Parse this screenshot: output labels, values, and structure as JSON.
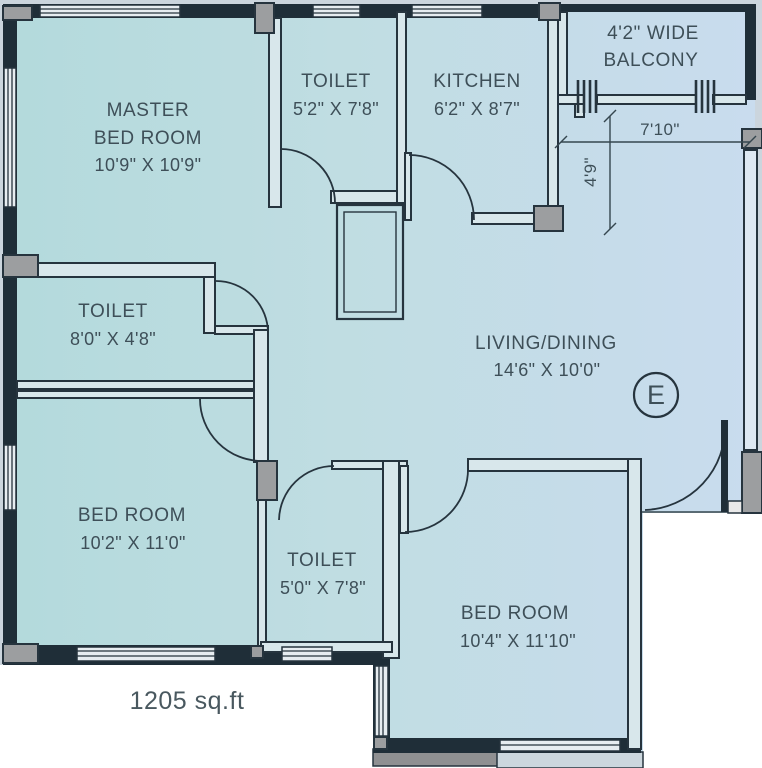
{
  "plan": {
    "rooms": [
      {
        "id": "master-bedroom",
        "lines": [
          "MASTER",
          "BED ROOM"
        ],
        "dims": "10'9\" X 10'9\""
      },
      {
        "id": "toilet-top",
        "name": "TOILET",
        "dims": "5'2\" X 7'8\""
      },
      {
        "id": "kitchen",
        "name": "KITCHEN",
        "dims": "6'2\" X 8'7\""
      },
      {
        "id": "balcony",
        "lines": [
          "4'2\" WIDE",
          "BALCONY"
        ]
      },
      {
        "id": "toilet-left",
        "name": "TOILET",
        "dims": "8'0\" X 4'8\""
      },
      {
        "id": "living-dining",
        "name": "LIVING/DINING",
        "dims": "14'6\" X 10'0\""
      },
      {
        "id": "bedroom-left",
        "name": "BED ROOM",
        "dims": "10'2\" X 11'0\""
      },
      {
        "id": "toilet-bottom",
        "name": "TOILET",
        "dims": "5'0\" X 7'8\""
      },
      {
        "id": "bedroom-right",
        "name": "BED ROOM",
        "dims": "10'4\" X 11'10\""
      }
    ],
    "annotations": {
      "balcony_width": "7'10\"",
      "balcony_depth": "4'9\"",
      "total_area": "1205 sq.ft",
      "compass": "E"
    },
    "colors": {
      "wall": "#1f2e38",
      "outside": "#cbd5dd",
      "room_fill_left": "#b3dadc",
      "room_fill_mid": "#c0dde2",
      "room_fill_right": "#c9dcee",
      "column": "#9c9ea0",
      "text": "#3e4f58",
      "white": "#ffffff"
    }
  }
}
